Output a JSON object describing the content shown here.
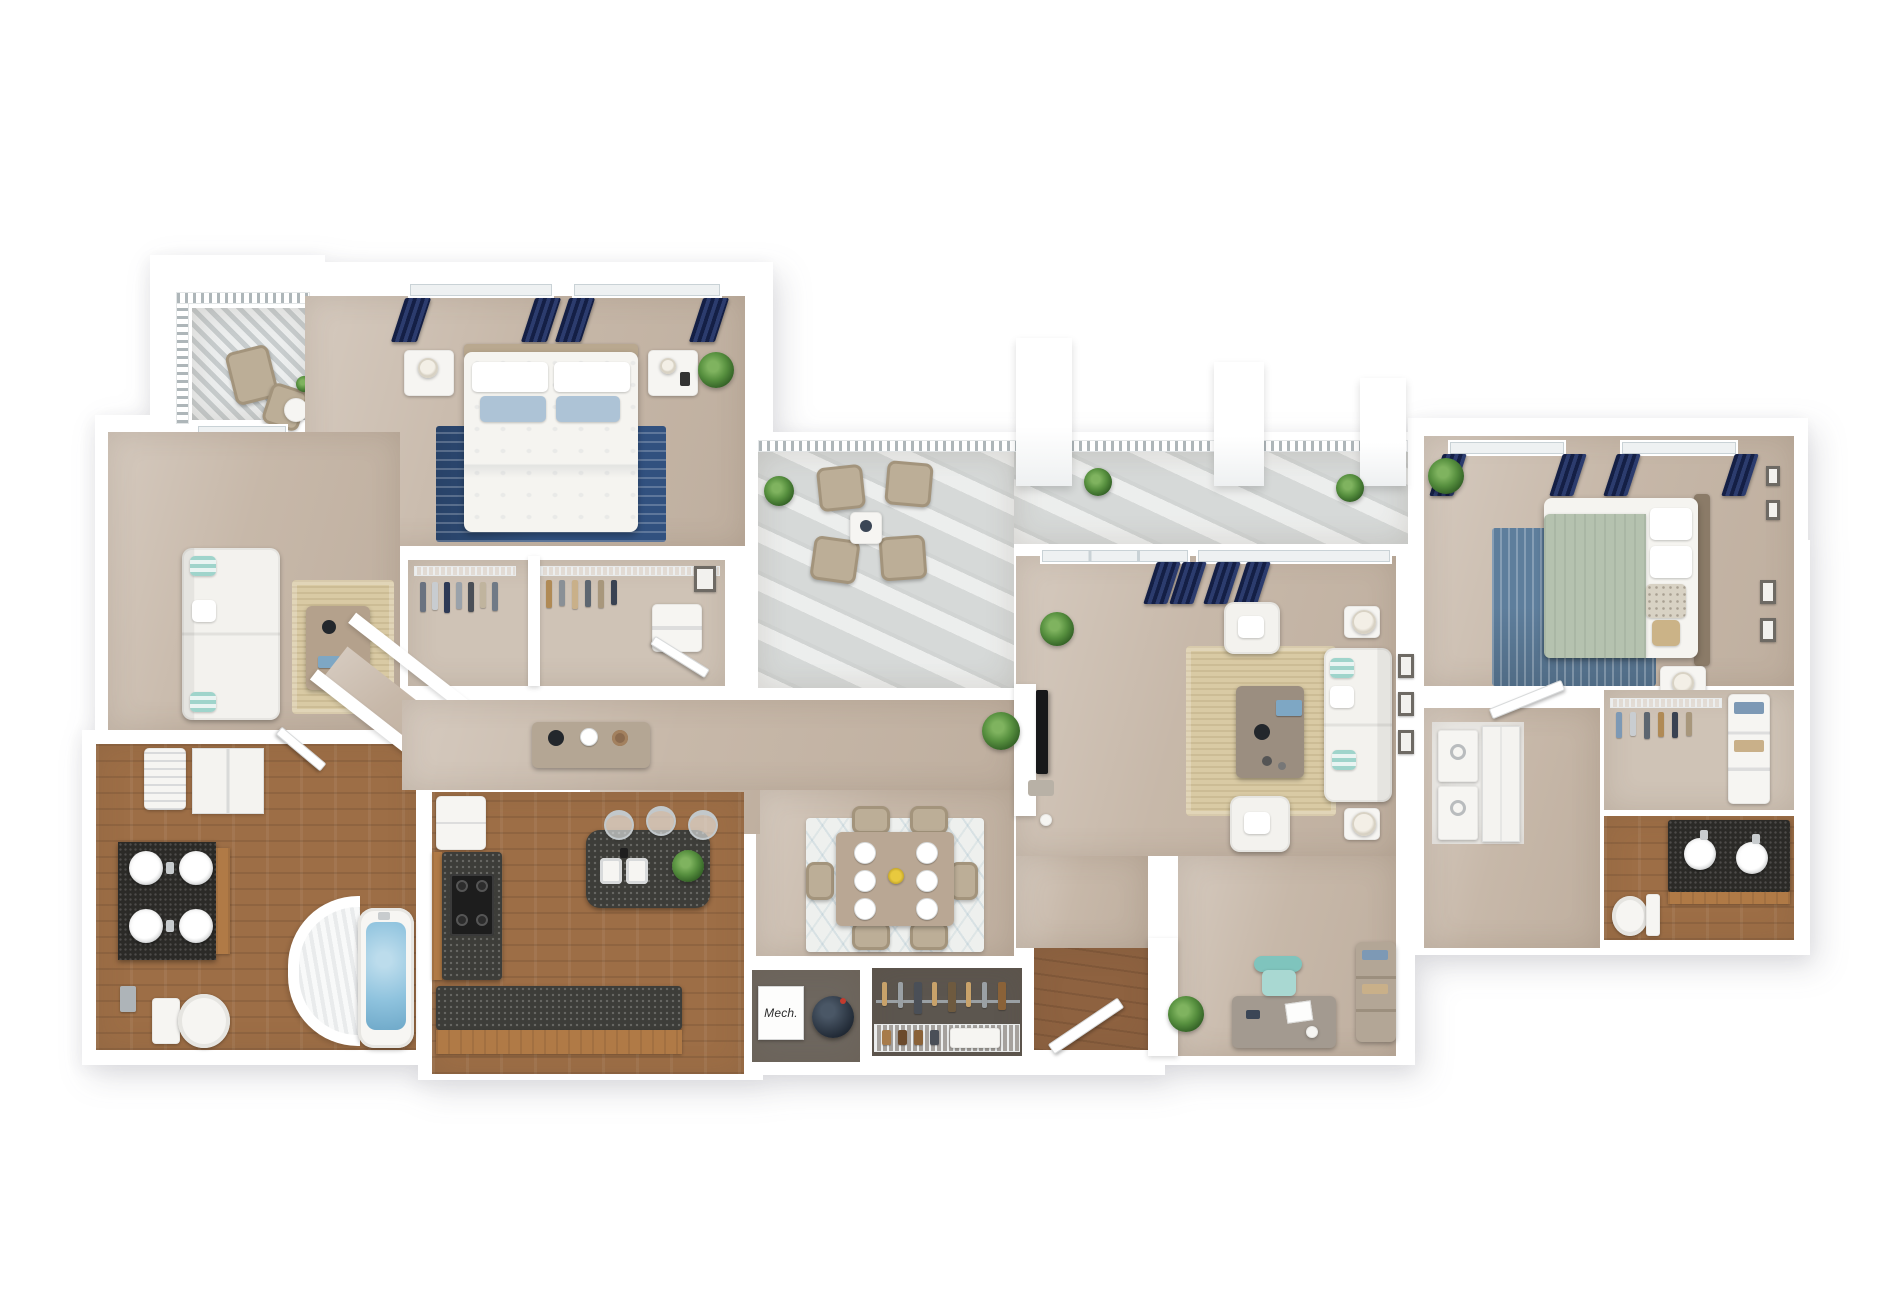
{
  "scene": {
    "title": "3D apartment floor plan rendering",
    "background": "#ffffff",
    "labels": {
      "mechanical_closet": "Mech."
    },
    "palette": {
      "wall": "#ffffff",
      "carpet_tan": "#c7b8a9",
      "hardwood": "#9d6e46",
      "hardwood_entry": "#8e6240",
      "balcony_concrete": "#d6d9d8",
      "balcony_lattice": "#dfe2e2",
      "granite_island": "#3d3d39",
      "granite_vanity": "#2b2a27",
      "navy_curtain": "#1e2b57",
      "rug_navy": "#31517f",
      "rug_steel_blue": "#5e7e9c",
      "rug_jute": "#d9caa4",
      "rug_dining": "#eef0ee",
      "sofa_white": "#f3f2ee",
      "pillow_teal": "#9fd4cb",
      "blanket_sage": "#b5c2af",
      "plant_green": "#4c7a3a",
      "patio_chair_beige": "#bcae97",
      "cabinet_wood": "#b07a46",
      "tub_water": "#8fc3de",
      "office_chair_teal": "#7fc4bd",
      "flower_yellow": "#e8c93e"
    },
    "rooms": [
      {
        "id": "balcony-small",
        "name": "small balcony",
        "furniture": [
          "patio-chair",
          "patio-chair",
          "side-table",
          "plant"
        ]
      },
      {
        "id": "bedroom-1",
        "name": "bedroom 1",
        "furniture": [
          "queen-bed",
          "nightstand",
          "nightstand",
          "navy-rug",
          "navy-curtains",
          "plant"
        ]
      },
      {
        "id": "closet-bedroom-1",
        "name": "bedroom 1 closet",
        "furniture": [
          "hanging-clothes",
          "wire-shelf",
          "dresser"
        ]
      },
      {
        "id": "den",
        "name": "den / sitting room",
        "furniture": [
          "white-sofa",
          "coffee-table",
          "jute-rug",
          "french-doors"
        ]
      },
      {
        "id": "bathroom-1",
        "name": "bathroom 1",
        "furniture": [
          "double-vanity",
          "vessel-sinks",
          "toilet",
          "curved-shower",
          "garden-tub",
          "linen-cabinet",
          "water-heater-closet"
        ]
      },
      {
        "id": "hallway",
        "name": "hallway",
        "furniture": [
          "console-table",
          "decor"
        ]
      },
      {
        "id": "kitchen",
        "name": "kitchen",
        "furniture": [
          "refrigerator",
          "range-stove",
          "l-counter",
          "granite-island",
          "double-sink",
          "bar-stool",
          "bar-stool",
          "bar-stool",
          "plant"
        ]
      },
      {
        "id": "dining-area",
        "name": "dining area",
        "furniture": [
          "dining-table",
          "dining-chair-x6",
          "place-settings",
          "patterned-rug",
          "flower-centerpiece"
        ]
      },
      {
        "id": "terrace",
        "name": "terrace balcony",
        "furniture": [
          "patio-chair-x4",
          "coffee-table",
          "railing",
          "planter-x3"
        ]
      },
      {
        "id": "living-room",
        "name": "living room",
        "furniture": [
          "tv-wall",
          "white-sofa",
          "armchair",
          "armchair",
          "coffee-table",
          "jute-rug",
          "floor-lamp-x2",
          "navy-curtains",
          "plants"
        ]
      },
      {
        "id": "mech-closet",
        "name": "mechanical closet",
        "furniture": [
          "mech-unit",
          "water-heater"
        ]
      },
      {
        "id": "coat-closet",
        "name": "coat closet",
        "furniture": [
          "hanging-rod",
          "wire-shelf",
          "shoes"
        ]
      },
      {
        "id": "entry",
        "name": "entry hall",
        "furniture": [
          "front-door"
        ]
      },
      {
        "id": "office-nook",
        "name": "office nook",
        "furniture": [
          "desk",
          "teal-office-chair",
          "bookshelf",
          "plant"
        ]
      },
      {
        "id": "bedroom-2",
        "name": "bedroom 2",
        "furniture": [
          "queen-bed",
          "sage-blanket",
          "steel-blue-rug",
          "nightstand",
          "lamp",
          "wall-frames",
          "navy-curtains",
          "plant"
        ]
      },
      {
        "id": "walk-in-closet",
        "name": "walk-in closet",
        "furniture": [
          "wire-racks",
          "shelf-tower"
        ]
      },
      {
        "id": "bathroom-2",
        "name": "bathroom 2",
        "furniture": [
          "double-vanity",
          "toilet"
        ]
      },
      {
        "id": "laundry-closet",
        "name": "laundry closet",
        "furniture": [
          "stacked-washer-dryer",
          "folding-doors"
        ]
      },
      {
        "id": "corridor",
        "name": "right corridor",
        "furniture": []
      }
    ]
  }
}
